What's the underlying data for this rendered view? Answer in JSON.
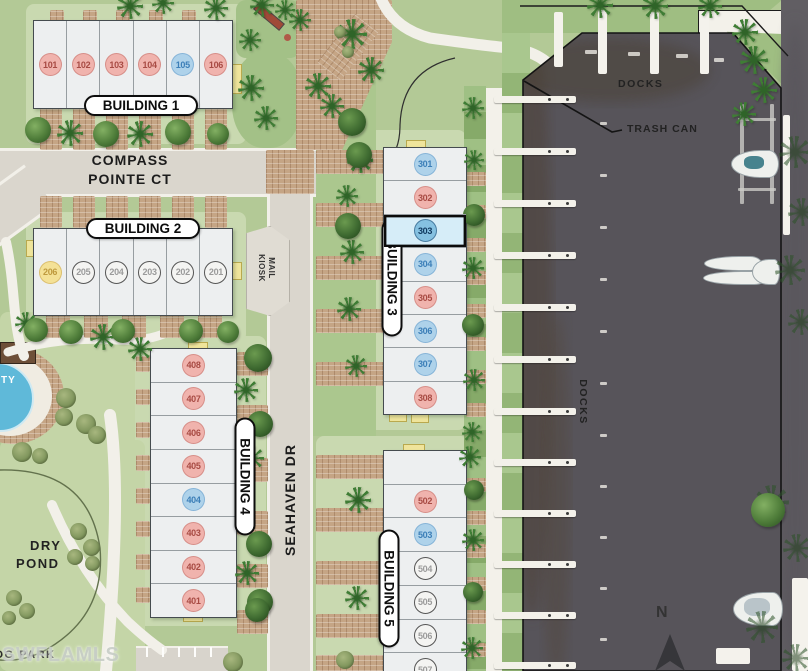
{
  "labels": {
    "docks_top": "DOCKS",
    "docks_side": "DOCKS",
    "trash_can": "TRASH CAN",
    "mail_kiosk_line1": "MAIL",
    "mail_kiosk_line2": "KIOSK",
    "dry_pond_line1": "DRY",
    "dry_pond_line2": "POND",
    "dog_park": "DOG PARK",
    "amenity_partial": "TY",
    "north": "N",
    "watermark": "SWFLAMLS"
  },
  "streets": {
    "compass_line1": "COMPASS",
    "compass_line2": "POINTE CT",
    "seahaven": "SEAHAVEN DR"
  },
  "status_colors": {
    "pink": "#f0b3ad",
    "blue": "#aed2ea",
    "sold": "#f4f4f2",
    "yellow": "#f4e196",
    "selected_fill": "#d6edf8"
  },
  "selected_unit": "303",
  "buildings": [
    {
      "label": "BUILDING 1",
      "units": [
        {
          "num": "101",
          "status": "pink"
        },
        {
          "num": "102",
          "status": "pink"
        },
        {
          "num": "103",
          "status": "pink"
        },
        {
          "num": "104",
          "status": "pink"
        },
        {
          "num": "105",
          "status": "blue"
        },
        {
          "num": "106",
          "status": "pink"
        }
      ]
    },
    {
      "label": "BUILDING 2",
      "units": [
        {
          "num": "206",
          "status": "yellow"
        },
        {
          "num": "205",
          "status": "sold"
        },
        {
          "num": "204",
          "status": "sold"
        },
        {
          "num": "203",
          "status": "sold"
        },
        {
          "num": "202",
          "status": "sold"
        },
        {
          "num": "201",
          "status": "sold"
        }
      ]
    },
    {
      "label": "BUILDING 3",
      "units": [
        {
          "num": "301",
          "status": "blue"
        },
        {
          "num": "302",
          "status": "pink"
        },
        {
          "num": "303",
          "status": "selected"
        },
        {
          "num": "304",
          "status": "blue"
        },
        {
          "num": "305",
          "status": "pink"
        },
        {
          "num": "306",
          "status": "blue"
        },
        {
          "num": "307",
          "status": "blue"
        },
        {
          "num": "308",
          "status": "pink"
        }
      ]
    },
    {
      "label": "BUILDING 4",
      "units": [
        {
          "num": "408",
          "status": "pink"
        },
        {
          "num": "407",
          "status": "pink"
        },
        {
          "num": "406",
          "status": "pink"
        },
        {
          "num": "405",
          "status": "pink"
        },
        {
          "num": "404",
          "status": "blue"
        },
        {
          "num": "403",
          "status": "pink"
        },
        {
          "num": "402",
          "status": "pink"
        },
        {
          "num": "401",
          "status": "pink"
        }
      ]
    },
    {
      "label": "BUILDING 5",
      "units": [
        {
          "num": "",
          "status": "none"
        },
        {
          "num": "502",
          "status": "pink"
        },
        {
          "num": "503",
          "status": "blue"
        },
        {
          "num": "504",
          "status": "sold"
        },
        {
          "num": "505",
          "status": "sold"
        },
        {
          "num": "506",
          "status": "sold"
        },
        {
          "num": "507",
          "status": "sold"
        }
      ]
    }
  ]
}
